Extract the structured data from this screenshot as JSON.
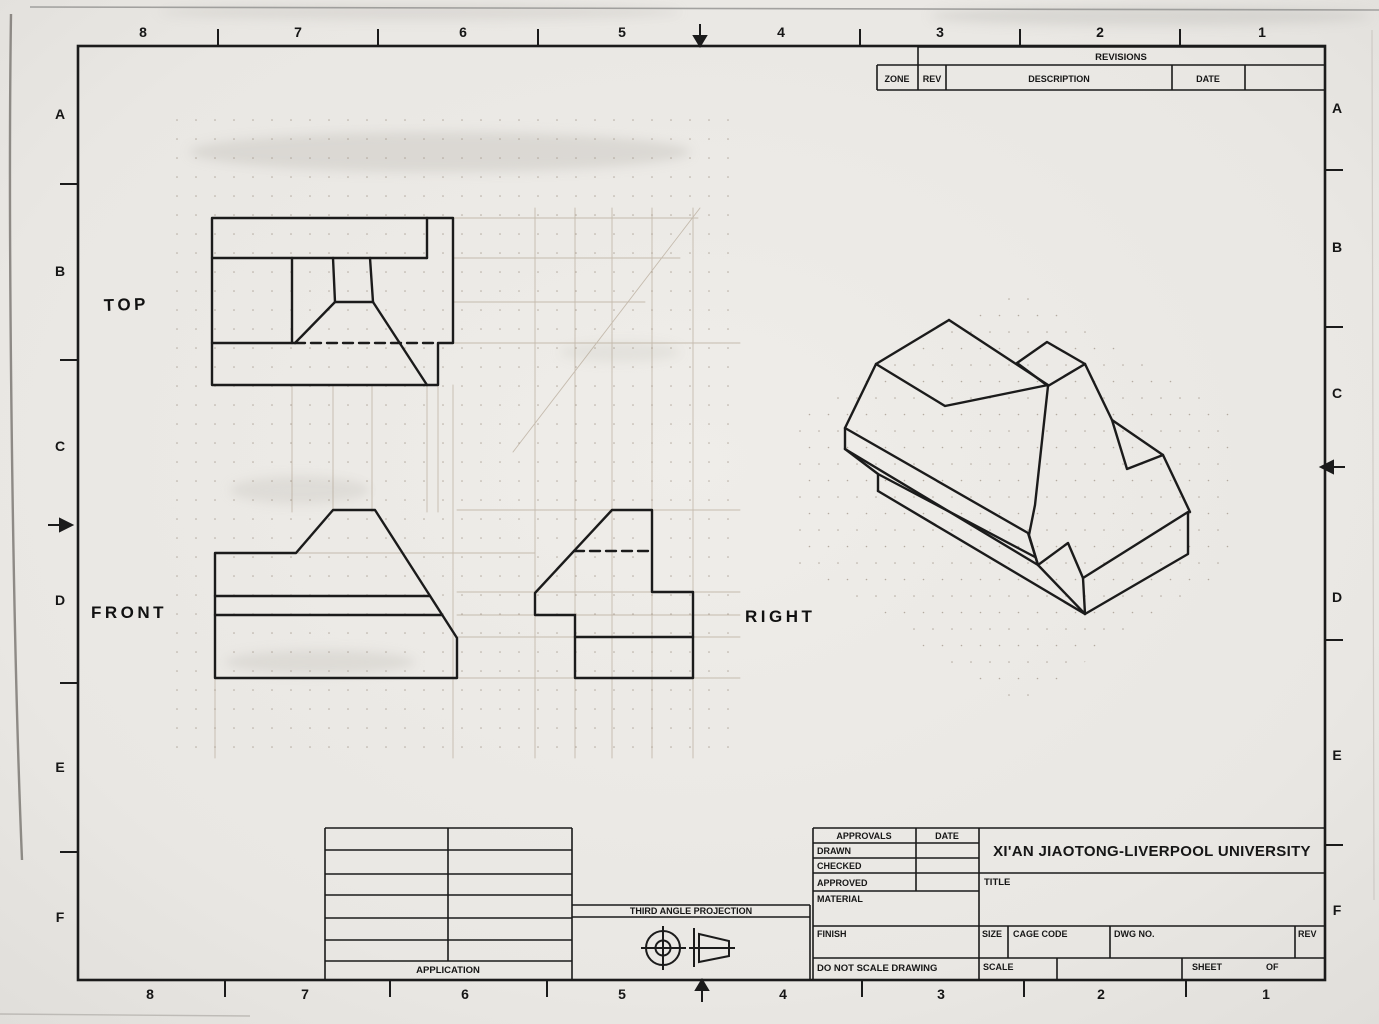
{
  "page": {
    "background": "#e9e7e3",
    "ink_color": "#1b1b1b",
    "pencil_color": "#a5947f"
  },
  "zones": {
    "top": [
      "8",
      "7",
      "6",
      "5",
      "4",
      "3",
      "2",
      "1"
    ],
    "bottom": [
      "8",
      "7",
      "6",
      "5",
      "4",
      "3",
      "2",
      "1"
    ],
    "left": [
      "A",
      "B",
      "C",
      "D",
      "E",
      "F"
    ],
    "right": [
      "A",
      "B",
      "C",
      "D",
      "E",
      "F"
    ]
  },
  "revisions": {
    "title": "REVISIONS",
    "zone": "ZONE",
    "rev": "REV",
    "description": "DESCRIPTION",
    "date": "DATE"
  },
  "views": {
    "top_label": "TOP",
    "front_label": "FRONT",
    "right_label": "RIGHT"
  },
  "title_block": {
    "approvals": "APPROVALS",
    "date": "DATE",
    "drawn": "DRAWN",
    "checked": "CHECKED",
    "approved": "APPROVED",
    "material": "MATERIAL",
    "finish": "FINISH",
    "do_not_scale": "DO NOT SCALE DRAWING",
    "company": "XI'AN JIAOTONG-LIVERPOOL UNIVERSITY",
    "title": "TITLE",
    "size": "SIZE",
    "cage_code": "CAGE CODE",
    "dwg_no": "DWG NO.",
    "rev": "REV",
    "scale": "SCALE",
    "sheet": "SHEET",
    "of": "OF"
  },
  "application": {
    "label": "APPLICATION"
  },
  "projection": {
    "label": "THIRD ANGLE PROJECTION"
  },
  "drawing": {
    "layers": [
      {
        "name": "construction-pencil",
        "stroke": "#a5947f",
        "width": 0.9,
        "opacity": 0.55,
        "lines": [
          [
            292,
            385,
            292,
            512
          ],
          [
            333,
            385,
            333,
            512
          ],
          [
            372,
            385,
            372,
            512
          ],
          [
            427,
            385,
            427,
            512
          ],
          [
            438,
            385,
            438,
            512
          ],
          [
            453,
            385,
            453,
            758
          ],
          [
            535,
            208,
            535,
            758
          ],
          [
            575,
            208,
            575,
            758
          ],
          [
            612,
            208,
            612,
            758
          ],
          [
            652,
            208,
            652,
            758
          ],
          [
            693,
            208,
            693,
            758
          ],
          [
            453,
            218,
            698,
            218
          ],
          [
            453,
            258,
            680,
            258
          ],
          [
            453,
            302,
            645,
            302
          ],
          [
            453,
            343,
            740,
            343
          ],
          [
            457,
            510,
            740,
            510
          ],
          [
            296,
            553,
            535,
            553
          ],
          [
            457,
            592,
            740,
            592
          ],
          [
            457,
            615,
            740,
            615
          ],
          [
            457,
            637,
            740,
            637
          ],
          [
            457,
            678,
            740,
            678
          ],
          [
            215,
            678,
            215,
            758
          ],
          [
            513,
            452,
            700,
            208
          ]
        ],
        "polylines": []
      },
      {
        "name": "object-lines",
        "stroke": "#1b1b1b",
        "width": 2.4,
        "opacity": 1,
        "lines": [],
        "polylines": [
          [
            [
              212,
              218
            ],
            [
              453,
              218
            ],
            [
              453,
              343
            ],
            [
              438,
              343
            ],
            [
              438,
              385
            ],
            [
              212,
              385
            ],
            [
              212,
              218
            ]
          ],
          [
            [
              212,
              258
            ],
            [
              427,
              258
            ]
          ],
          [
            [
              427,
              218
            ],
            [
              427,
              258
            ]
          ],
          [
            [
              292,
              258
            ],
            [
              292,
              343
            ]
          ],
          [
            [
              212,
              343
            ],
            [
              295,
              343
            ]
          ],
          [
            [
              333,
              258
            ],
            [
              335,
              302
            ]
          ],
          [
            [
              370,
              258
            ],
            [
              373,
              302
            ]
          ],
          [
            [
              335,
              302
            ],
            [
              373,
              302
            ]
          ],
          [
            [
              335,
              302
            ],
            [
              295,
              343
            ]
          ],
          [
            [
              373,
              302
            ],
            [
              427,
              385
            ]
          ],
          [
            [
              215,
              553
            ],
            [
              296,
              553
            ],
            [
              333,
              510
            ],
            [
              375,
              510
            ],
            [
              457,
              638
            ],
            [
              457,
              678
            ],
            [
              215,
              678
            ],
            [
              215,
              553
            ]
          ],
          [
            [
              215,
              596
            ],
            [
              430,
              596
            ]
          ],
          [
            [
              215,
              615
            ],
            [
              442,
              615
            ]
          ],
          [
            [
              612,
              510
            ],
            [
              652,
              510
            ],
            [
              652,
              592
            ],
            [
              693,
              592
            ],
            [
              693,
              678
            ],
            [
              575,
              678
            ],
            [
              575,
              615
            ],
            [
              535,
              615
            ],
            [
              535,
              593
            ],
            [
              612,
              510
            ]
          ],
          [
            [
              575,
              637
            ],
            [
              693,
              637
            ]
          ],
          [
            [
              949,
              320
            ],
            [
              876,
              364
            ],
            [
              845,
              428
            ],
            [
              845,
              449
            ]
          ],
          [
            [
              876,
              364
            ],
            [
              945,
              406
            ],
            [
              1048,
              385
            ],
            [
              949,
              320
            ]
          ],
          [
            [
              1017,
              363
            ],
            [
              1047,
              342
            ],
            [
              1085,
              364
            ],
            [
              1048,
              386
            ],
            [
              1017,
              363
            ]
          ],
          [
            [
              1048,
              386
            ],
            [
              1035,
              505
            ],
            [
              1029,
              535
            ],
            [
              1038,
              565
            ]
          ],
          [
            [
              845,
              428
            ],
            [
              1028,
              533
            ],
            [
              1038,
              565
            ]
          ],
          [
            [
              845,
              449
            ],
            [
              1038,
              565
            ]
          ],
          [
            [
              845,
              449
            ],
            [
              878,
              474
            ],
            [
              878,
              491
            ]
          ],
          [
            [
              878,
              474
            ],
            [
              1035,
              557
            ]
          ],
          [
            [
              878,
              491
            ],
            [
              1085,
              614
            ]
          ],
          [
            [
              1085,
              614
            ],
            [
              1038,
              565
            ],
            [
              1068,
              543
            ],
            [
              1083,
              578
            ],
            [
              1085,
              614
            ]
          ],
          [
            [
              1083,
              578
            ],
            [
              1188,
              512
            ],
            [
              1188,
              554
            ],
            [
              1085,
              614
            ]
          ],
          [
            [
              1085,
              364
            ],
            [
              1112,
              420
            ]
          ],
          [
            [
              1112,
              420
            ],
            [
              1127,
              469
            ],
            [
              1163,
              455
            ],
            [
              1112,
              420
            ]
          ],
          [
            [
              1163,
              455
            ],
            [
              1190,
              512
            ]
          ]
        ]
      },
      {
        "name": "hidden-lines",
        "stroke": "#1b1b1b",
        "width": 2.4,
        "opacity": 1,
        "dash": "10,6",
        "lines": [
          [
            295,
            343,
            438,
            343
          ],
          [
            574,
            551,
            652,
            551
          ]
        ],
        "polylines": []
      }
    ]
  }
}
